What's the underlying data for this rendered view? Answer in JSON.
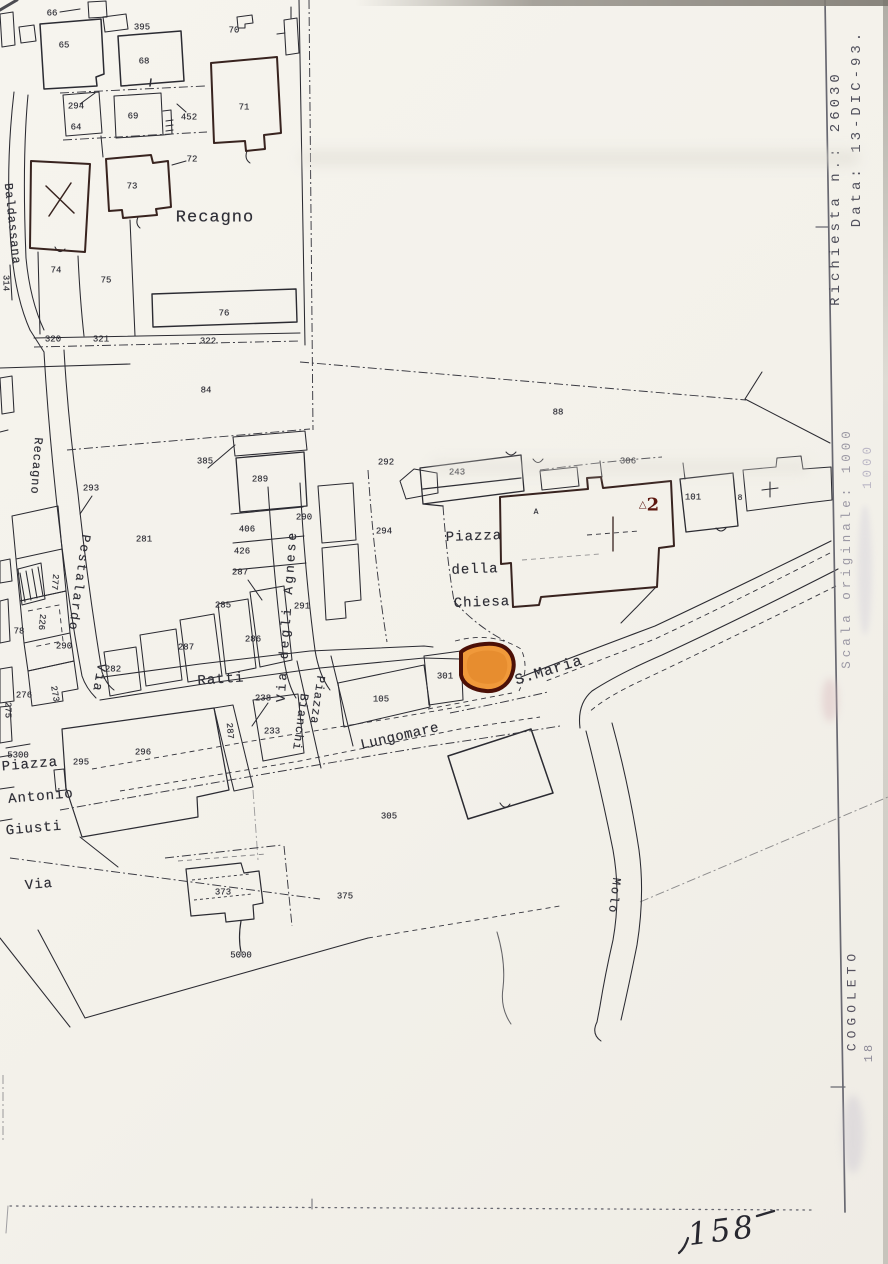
{
  "margin": {
    "richiesta": "Richiesta n.: 26030",
    "data": "Data: 13-DIC-93.",
    "scala_line1": "Scala originale: 1000",
    "scala_line2": "1000",
    "comune": "COGOLETO",
    "foglio": "18",
    "handwritten": "158"
  },
  "map": {
    "highlight_color": "#f0993a",
    "highlight_outline": "#4c1007",
    "benchmark": {
      "symbol": "△",
      "number": "2",
      "color": "#5c170f"
    },
    "street_labels": [
      {
        "text": "Baldassana",
        "x": 12,
        "y": 224,
        "mode": "vd",
        "size": 12,
        "ls": 1,
        "rot": -6
      },
      {
        "text": "Recagno",
        "x": 215,
        "y": 218,
        "mode": "h",
        "size": 17,
        "ls": 1,
        "rot": 0
      },
      {
        "text": "Recagno",
        "x": 36,
        "y": 466,
        "mode": "vd",
        "size": 12,
        "ls": 1,
        "rot": 4
      },
      {
        "text": "Pestalardo",
        "x": 79,
        "y": 583,
        "mode": "vd",
        "size": 13,
        "ls": 2,
        "rot": 8
      },
      {
        "text": "Via",
        "x": 99,
        "y": 678,
        "mode": "vd",
        "size": 13,
        "ls": 2,
        "rot": 10
      },
      {
        "text": "Via degli Agnese",
        "x": 287,
        "y": 616,
        "mode": "vu",
        "size": 13,
        "ls": 3,
        "rot": 4
      },
      {
        "text": "Piazza",
        "x": 317,
        "y": 700,
        "mode": "vd",
        "size": 12,
        "ls": 1,
        "rot": 8
      },
      {
        "text": "Bianchi",
        "x": 300,
        "y": 722,
        "mode": "vd",
        "size": 12,
        "ls": 1,
        "rot": 8
      },
      {
        "text": "Ratti",
        "x": 221,
        "y": 680,
        "mode": "h",
        "size": 14,
        "ls": 1,
        "rot": -4
      },
      {
        "text": "S.Maria",
        "x": 549,
        "y": 671,
        "mode": "h",
        "size": 15,
        "ls": 1,
        "rot": -17
      },
      {
        "text": "Lungomare",
        "x": 400,
        "y": 737,
        "mode": "h",
        "size": 14,
        "ls": 0.5,
        "rot": -13
      },
      {
        "text": "Piazza",
        "x": 474,
        "y": 537,
        "mode": "h",
        "size": 14,
        "ls": 1,
        "rot": -2
      },
      {
        "text": "della",
        "x": 475,
        "y": 570,
        "mode": "h",
        "size": 14,
        "ls": 1,
        "rot": -2
      },
      {
        "text": "Chiesa",
        "x": 482,
        "y": 603,
        "mode": "h",
        "size": 14,
        "ls": 1,
        "rot": -2
      },
      {
        "text": "Piazza",
        "x": 30,
        "y": 765,
        "mode": "h",
        "size": 14,
        "ls": 1,
        "rot": -5
      },
      {
        "text": "Antonio",
        "x": 41,
        "y": 797,
        "mode": "h",
        "size": 14,
        "ls": 1,
        "rot": -5
      },
      {
        "text": "Giusti",
        "x": 34,
        "y": 829,
        "mode": "h",
        "size": 14,
        "ls": 1,
        "rot": -5
      },
      {
        "text": "Via",
        "x": 39,
        "y": 885,
        "mode": "h",
        "size": 14,
        "ls": 1,
        "rot": -5
      },
      {
        "text": "Molo",
        "x": 614,
        "y": 896,
        "mode": "vd",
        "size": 12,
        "ls": 2,
        "rot": 7
      }
    ],
    "parcel_numbers": [
      {
        "text": "66",
        "x": 52,
        "y": 14
      },
      {
        "text": "395",
        "x": 142,
        "y": 28
      },
      {
        "text": "70",
        "x": 234,
        "y": 31
      },
      {
        "text": "65",
        "x": 64,
        "y": 46
      },
      {
        "text": "68",
        "x": 144,
        "y": 62
      },
      {
        "text": "294",
        "x": 76,
        "y": 107
      },
      {
        "text": "64",
        "x": 76,
        "y": 128
      },
      {
        "text": "69",
        "x": 133,
        "y": 117
      },
      {
        "text": "452",
        "x": 189,
        "y": 118
      },
      {
        "text": "71",
        "x": 244,
        "y": 108
      },
      {
        "text": "72",
        "x": 192,
        "y": 160
      },
      {
        "text": "73",
        "x": 132,
        "y": 187
      },
      {
        "text": "74",
        "x": 56,
        "y": 271
      },
      {
        "text": "75",
        "x": 106,
        "y": 281
      },
      {
        "text": "76",
        "x": 224,
        "y": 314
      },
      {
        "text": "314",
        "x": 5,
        "y": 283,
        "rot": 90
      },
      {
        "text": "320",
        "x": 53,
        "y": 340
      },
      {
        "text": "321",
        "x": 101,
        "y": 340
      },
      {
        "text": "322",
        "x": 208,
        "y": 342
      },
      {
        "text": "84",
        "x": 206,
        "y": 391
      },
      {
        "text": "88",
        "x": 558,
        "y": 413
      },
      {
        "text": "293",
        "x": 91,
        "y": 489
      },
      {
        "text": "385",
        "x": 205,
        "y": 462
      },
      {
        "text": "289",
        "x": 260,
        "y": 480
      },
      {
        "text": "292",
        "x": 386,
        "y": 463
      },
      {
        "text": "290",
        "x": 304,
        "y": 518
      },
      {
        "text": "294",
        "x": 384,
        "y": 532
      },
      {
        "text": "281",
        "x": 144,
        "y": 540
      },
      {
        "text": "406",
        "x": 247,
        "y": 530
      },
      {
        "text": "426",
        "x": 242,
        "y": 552
      },
      {
        "text": "287",
        "x": 240,
        "y": 573
      },
      {
        "text": "291",
        "x": 302,
        "y": 607
      },
      {
        "text": "285",
        "x": 223,
        "y": 606
      },
      {
        "text": "286",
        "x": 253,
        "y": 640
      },
      {
        "text": "287",
        "x": 186,
        "y": 648
      },
      {
        "text": "290",
        "x": 64,
        "y": 647
      },
      {
        "text": "78",
        "x": 19,
        "y": 632
      },
      {
        "text": "277",
        "x": 54,
        "y": 582,
        "rot": 95
      },
      {
        "text": "226",
        "x": 41,
        "y": 622,
        "rot": 95
      },
      {
        "text": "282",
        "x": 113,
        "y": 670
      },
      {
        "text": "276",
        "x": 24,
        "y": 696
      },
      {
        "text": "273",
        "x": 54,
        "y": 694,
        "rot": 80
      },
      {
        "text": "275",
        "x": 7,
        "y": 710,
        "rot": 90
      },
      {
        "text": "238",
        "x": 263,
        "y": 699
      },
      {
        "text": "233",
        "x": 272,
        "y": 732
      },
      {
        "text": "287",
        "x": 229,
        "y": 731,
        "rot": 85
      },
      {
        "text": "243",
        "x": 457,
        "y": 473
      },
      {
        "text": "306",
        "x": 628,
        "y": 462
      },
      {
        "text": "A",
        "x": 536,
        "y": 513,
        "size": 8
      },
      {
        "text": "101",
        "x": 693,
        "y": 498
      },
      {
        "text": "8",
        "x": 740,
        "y": 499,
        "size": 8
      },
      {
        "text": "301",
        "x": 445,
        "y": 677
      },
      {
        "text": "105",
        "x": 381,
        "y": 700
      },
      {
        "text": "296",
        "x": 143,
        "y": 753
      },
      {
        "text": "295",
        "x": 81,
        "y": 763
      },
      {
        "text": "5300",
        "x": 18,
        "y": 756
      },
      {
        "text": "305",
        "x": 389,
        "y": 817
      },
      {
        "text": "375",
        "x": 345,
        "y": 897
      },
      {
        "text": "373",
        "x": 223,
        "y": 893
      },
      {
        "text": "5000",
        "x": 241,
        "y": 956
      }
    ]
  }
}
